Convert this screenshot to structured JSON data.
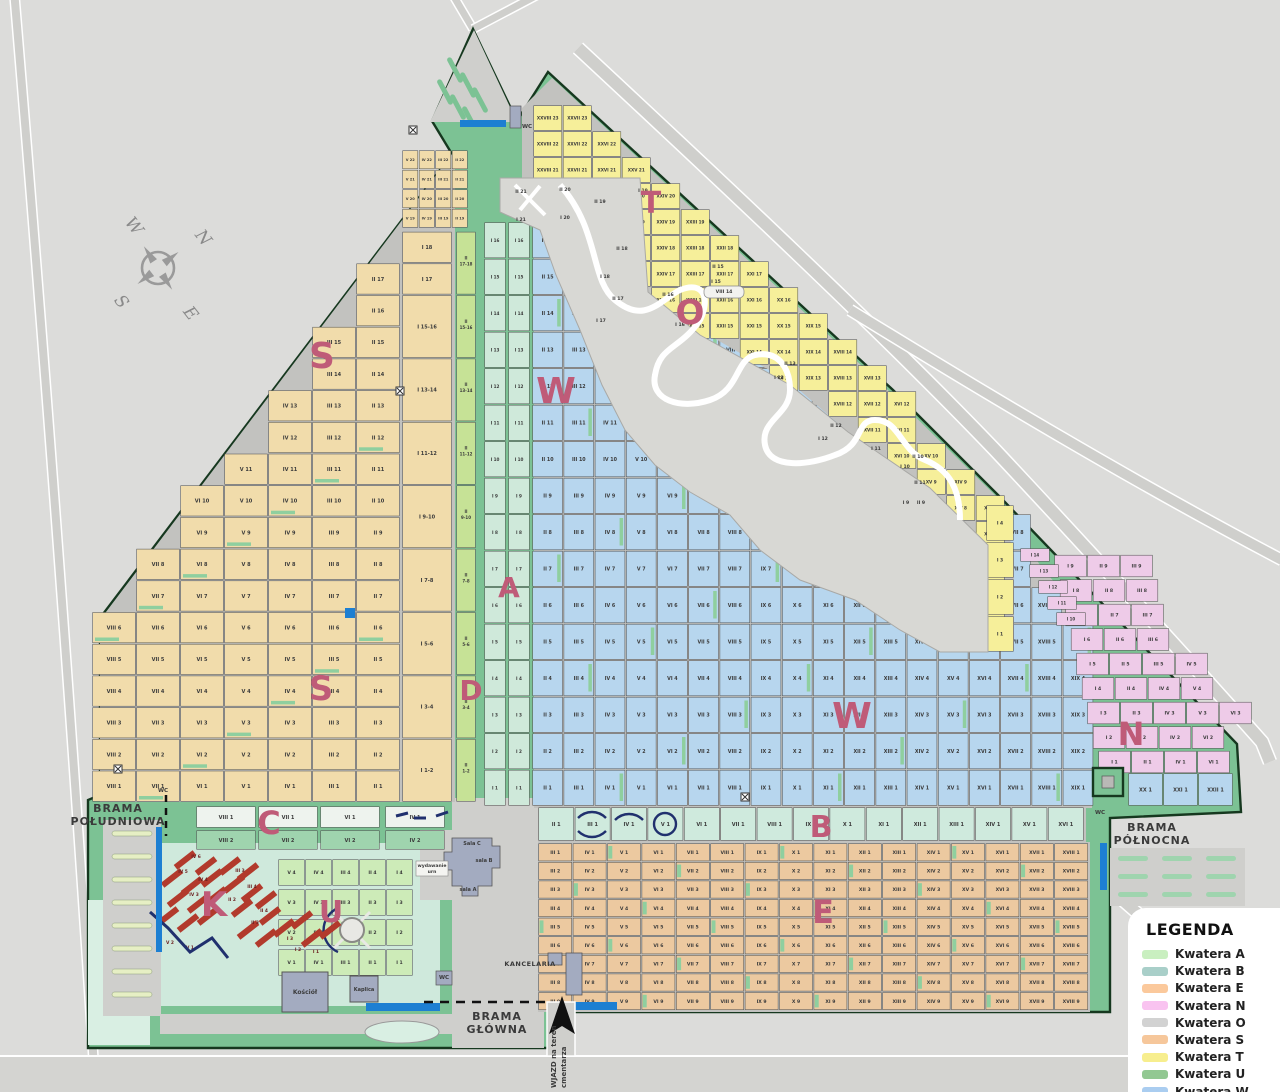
{
  "colors": {
    "background": "#dcdcda",
    "road_fill": "#cfcfcc",
    "road_casing": "#ffffff",
    "cemetery_green": "#7cc294",
    "pale_mint": "#cfe9dc",
    "pale_mint2": "#d9efe3",
    "grid_bg": "#c2c2bf",
    "fence": "#16381f",
    "letter": "#bf5b78",
    "water": "#1d7fd2",
    "red_bar": "#b23a2c",
    "navy": "#20306e",
    "building": "#a3abc0",
    "S": "#f1dcab",
    "W": "#b7d6ee",
    "T": "#f6ef9a",
    "E": "#ecc9a0",
    "B": "#cfeadd",
    "U": "#cdebb8",
    "N": "#eecbe8",
    "A": "#c6e296",
    "D": "#cfe9da",
    "O": "#d8d8d4",
    "C1": "#eef3ee",
    "C2": "#9fd4ae"
  },
  "legend": {
    "title": "LEGENDA",
    "items": [
      {
        "label": "Kwatera A",
        "color": "#c9efc0"
      },
      {
        "label": "Kwatera B",
        "color": "#a9cfc9"
      },
      {
        "label": "Kwatera E",
        "color": "#fbc99c"
      },
      {
        "label": "Kwatera N",
        "color": "#f9c3f0"
      },
      {
        "label": "Kwatera O",
        "color": "#d2d2d2"
      },
      {
        "label": "Kwatera S",
        "color": "#f6c79b"
      },
      {
        "label": "Kwatera T",
        "color": "#f7ee8e"
      },
      {
        "label": "Kwatera U",
        "color": "#92c892"
      },
      {
        "label": "Kwatera W",
        "color": "#aacdf0"
      }
    ]
  },
  "gates": {
    "south": [
      "BRAMA",
      "POŁUDNIOWA"
    ],
    "north": [
      "BRAMA",
      "PÓŁNOCNA"
    ],
    "main": [
      "BRAMA",
      "GŁÓWNA"
    ]
  },
  "landmarks": {
    "church": "Kościół",
    "chapel": "Kaplica",
    "office": "KANCELARIA",
    "hall_c": "Sala C",
    "hall_b": "sala B",
    "hall_a": "sala A",
    "urns": [
      "wydawanie",
      "urn"
    ],
    "wc": "WC",
    "entry_lines": [
      "WJAZD na teren",
      "cmentarza"
    ]
  },
  "compass": {
    "n": "N",
    "e": "E",
    "s": "S",
    "w": "W"
  },
  "letters": [
    "S",
    "W",
    "T",
    "O",
    "A",
    "D",
    "S",
    "W",
    "B",
    "E",
    "N",
    "K",
    "U",
    "C"
  ],
  "grids": {
    "S": {
      "cols": [
        "II",
        "III",
        "IV",
        "V",
        "VI",
        "VII",
        "VIII",
        "IX",
        "X"
      ],
      "rows": [
        1,
        18
      ]
    },
    "S_I": {
      "labels": [
        "I 18",
        "I 17",
        "I 15-16",
        "I 13-14",
        "I 11-12",
        "I 9-10",
        "I 7-8",
        "I 5-6",
        "I 3-4",
        "I 1-2"
      ],
      "spans": [
        1,
        1,
        2,
        2,
        2,
        2,
        2,
        2,
        2,
        2
      ]
    },
    "S_top": {
      "cols": [
        "V",
        "IV",
        "III",
        "II"
      ],
      "rows": [
        19,
        22
      ]
    },
    "A": {
      "labels": [
        "II 17-18",
        "II 15-16",
        "II 13-14",
        "II 11-12",
        "II 9-10",
        "II 7-8",
        "II 5-6",
        "II 3-4",
        "II 1-2"
      ]
    },
    "D": {
      "cols": [
        "I",
        "I"
      ],
      "rows": [
        1,
        16
      ]
    },
    "W": {
      "cols": [
        "II",
        "III",
        "IV",
        "V",
        "VI",
        "VII",
        "VIII",
        "IX",
        "X",
        "XI",
        "XII",
        "XIII",
        "XIV",
        "XV",
        "XVI",
        "XVII",
        "XVIII",
        "XIX"
      ],
      "rows": [
        1,
        16
      ]
    },
    "W_extra": [
      "XX 1",
      "XXI 1",
      "XXII 1"
    ],
    "T": {
      "cols": [
        "XXVIII",
        "XXVII",
        "XXVI",
        "XXV",
        "XXIV",
        "XXIII",
        "XXII",
        "XXI",
        "XX",
        "XIX",
        "XVIII",
        "XVII",
        "XVI",
        "XV",
        "XIV",
        "XIII"
      ],
      "rows": [
        4,
        23
      ]
    },
    "T_strip": [
      "I 4",
      "I 3",
      "I 2",
      "I 1"
    ],
    "E": {
      "cols": [
        "III",
        "IV",
        "V",
        "VI",
        "VII",
        "VIII",
        "IX",
        "X",
        "XI",
        "XII",
        "XIII",
        "XIV",
        "XV",
        "XVI",
        "XVII",
        "XVIII"
      ],
      "rows": [
        1,
        9
      ]
    },
    "B": {
      "cols": [
        "II",
        "III",
        "IV",
        "V",
        "VI",
        "VII",
        "VIII",
        "IX",
        "X",
        "XI",
        "XII",
        "XIII",
        "XIV",
        "XV",
        "XVI"
      ],
      "row": 1
    },
    "U": {
      "cols": [
        "V",
        "IV",
        "III",
        "II",
        "I"
      ],
      "rows": [
        1,
        4
      ]
    },
    "N": {
      "rows": [
        {
          "r": 1,
          "cols": [
            "I",
            "II",
            "IV",
            "VI"
          ]
        },
        {
          "r": 2,
          "cols": [
            "I",
            "II",
            "IV",
            "VI"
          ]
        },
        {
          "r": 3,
          "cols": [
            "I",
            "II",
            "IV",
            "V",
            "VI"
          ]
        },
        {
          "r": 4,
          "cols": [
            "I",
            "II",
            "IV",
            "V"
          ]
        },
        {
          "r": 5,
          "cols": [
            "I",
            "II",
            "III",
            "IV"
          ]
        },
        {
          "r": 6,
          "cols": [
            "I",
            "II",
            "III"
          ]
        },
        {
          "r": 7,
          "cols": [
            "I",
            "II",
            "III"
          ]
        },
        {
          "r": 8,
          "cols": [
            "I",
            "II",
            "III"
          ]
        },
        {
          "r": 9,
          "cols": [
            "I",
            "II",
            "III"
          ]
        }
      ],
      "upper": [
        "I 10",
        "I 11",
        "I 12",
        "I 13",
        "I 14"
      ]
    }
  },
  "o_plots": [
    "II 21",
    "I 21",
    "II 20",
    "I 20",
    "II 19",
    "I 19",
    "II 18",
    "I 18",
    "II 17",
    "I 17",
    "II 16",
    "I 16",
    "II 15",
    "I 15",
    "VIII 14",
    "II 13",
    "I 13",
    "II 12",
    "I 12",
    "I 11",
    "II 11",
    "I 10",
    "II 10",
    "I 9",
    "II 9"
  ],
  "k_plots": [
    "IV 6",
    "IV 5",
    "IV 4",
    "IV 3",
    "III 3",
    "III 4",
    "II 2",
    "II 4",
    "II 3",
    "I 3",
    "I 2",
    "I 1",
    "V 2",
    "V 1"
  ],
  "c_cells": {
    "row1": [
      "VIII 1",
      "VII 1",
      "VI 1",
      "IV 1"
    ],
    "row2": [
      "VIII 2",
      "VII 2",
      "VI 2",
      "IV 2"
    ]
  }
}
